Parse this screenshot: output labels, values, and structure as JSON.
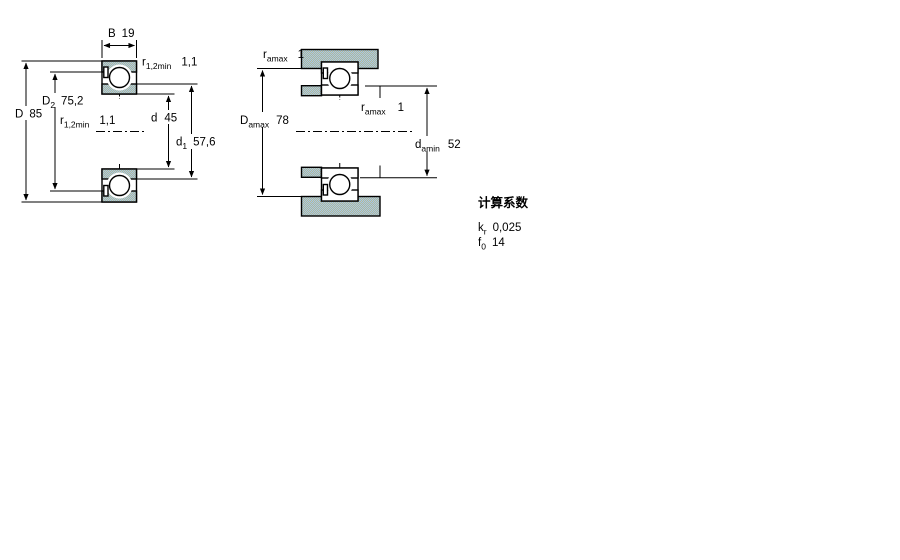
{
  "meta": {
    "background_color": "#ffffff",
    "line_color": "#000000",
    "hatch_color_blue": "#a5c8e8",
    "hatch_color_khaki": "#b4b896"
  },
  "left_view": {
    "b": {
      "symbol": "B",
      "value": "19"
    },
    "r_top": {
      "symbol": "r",
      "sub": "1,2min",
      "value": "1,1"
    },
    "d_outer": {
      "symbol": "D",
      "value": "85"
    },
    "d2": {
      "symbol": "D",
      "sub": "2",
      "value": "75,2"
    },
    "r_mid": {
      "symbol": "r",
      "sub": "1,2min",
      "value": "1,1"
    },
    "d_bore": {
      "symbol": "d",
      "value": "45"
    },
    "d1": {
      "symbol": "d",
      "sub": "1",
      "value": "57,6"
    }
  },
  "right_view": {
    "r_top": {
      "symbol": "r",
      "sub": "amax",
      "value": "1"
    },
    "da_max": {
      "symbol": "D",
      "sub": "amax",
      "value": "78"
    },
    "r_mid": {
      "symbol": "r",
      "sub": "amax",
      "value": "1"
    },
    "da_min": {
      "symbol": "d",
      "sub": "amin",
      "value": "52"
    }
  },
  "factors": {
    "title": "计算系数",
    "kr": {
      "symbol": "k",
      "sub": "r",
      "value": "0,025"
    },
    "f0": {
      "symbol": "f",
      "sub": "0",
      "value": "14"
    }
  }
}
